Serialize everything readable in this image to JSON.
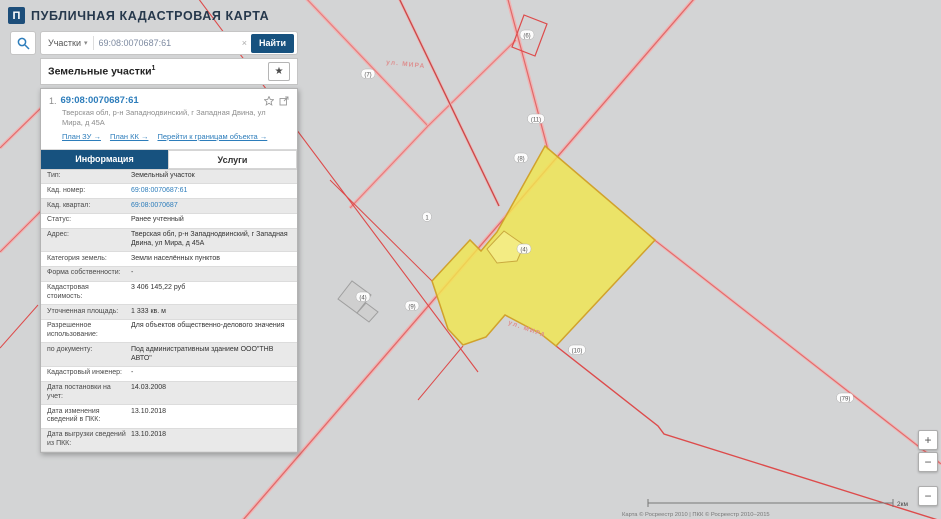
{
  "app": {
    "logo_glyph": "П",
    "title": "ПУБЛИЧНАЯ КАДАСТРОВАЯ КАРТА"
  },
  "search": {
    "category": "Участки",
    "caret": "▾",
    "value": "69:08:0070687:61",
    "clear": "×",
    "button_label": "Найти"
  },
  "results": {
    "title": "Земельные участки",
    "count": "1",
    "favorite_icon": "★"
  },
  "parcel": {
    "index": "1.",
    "cad_number": "69:08:0070687:61",
    "address": "Тверская обл, р-н Западнодвинский, г Западная Двина, ул Мира, д 45А",
    "links": {
      "plan_zu": "План ЗУ →",
      "plan_kk": "План КК →",
      "goto_bounds": "Перейти к границам объекта →"
    },
    "tabs": {
      "info": "Информация",
      "services": "Услуги"
    },
    "fields": [
      {
        "label": "Тип:",
        "value": "Земельный участок",
        "link": false
      },
      {
        "label": "Кад. номер:",
        "value": "69:08:0070687:61",
        "link": true
      },
      {
        "label": "Кад. квартал:",
        "value": "69:08:0070687",
        "link": true
      },
      {
        "label": "Статус:",
        "value": "Ранее учтенный",
        "link": false
      },
      {
        "label": "Адрес:",
        "value": "Тверская обл, р-н Западнодвинский, г Западная Двина, ул Мира, д 45А",
        "link": false
      },
      {
        "label": "Категория земель:",
        "value": "Земли населённых пунктов",
        "link": false
      },
      {
        "label": "Форма собственности:",
        "value": "-",
        "link": false
      },
      {
        "label": "Кадастровая стоимость:",
        "value": "3 406 145,22 руб",
        "link": false
      },
      {
        "label": "Уточненная площадь:",
        "value": "1 333 кв. м",
        "link": false
      },
      {
        "label": "Разрешенное использование:",
        "value": "Для объектов общественно-делового значения",
        "link": false
      },
      {
        "label": "по документу:",
        "value": "Под административным зданием ООО\"ТНВ АВТО\"",
        "link": false
      },
      {
        "label": "Кадастровый инженер:",
        "value": "-",
        "link": false
      },
      {
        "label": "Дата постановки на учет:",
        "value": "14.03.2008",
        "link": false
      },
      {
        "label": "Дата изменения сведений в ПКК:",
        "value": "13.10.2018",
        "link": false
      },
      {
        "label": "Дата выгрузки сведений из ПКК:",
        "value": "13.10.2018",
        "link": false
      }
    ]
  },
  "map": {
    "street_labels": [
      "ул. МИРА",
      "ул. МИРА"
    ],
    "ovals": [
      "(6)",
      "(7)",
      "(11)",
      "(8)",
      "1",
      "(4)",
      "(4)",
      "(9)",
      "(10)",
      "(79)"
    ],
    "attribution": "Карта © Росреестр 2010 | ПКК © Росреестр 2010–2015",
    "scale_label": "2км",
    "controls": {
      "zoom_in": "+",
      "zoom_out": "−",
      "tool": "−"
    },
    "colors": {
      "background": "#d3d4d5",
      "selected_parcel_fill": "#f0e64f",
      "selected_parcel_stroke": "#d1a22c",
      "boundary_red": "#dd4b4b",
      "road_pink": "#f0b4b4",
      "accent_blue": "#17527f",
      "link_blue": "#2d7dbb"
    }
  }
}
